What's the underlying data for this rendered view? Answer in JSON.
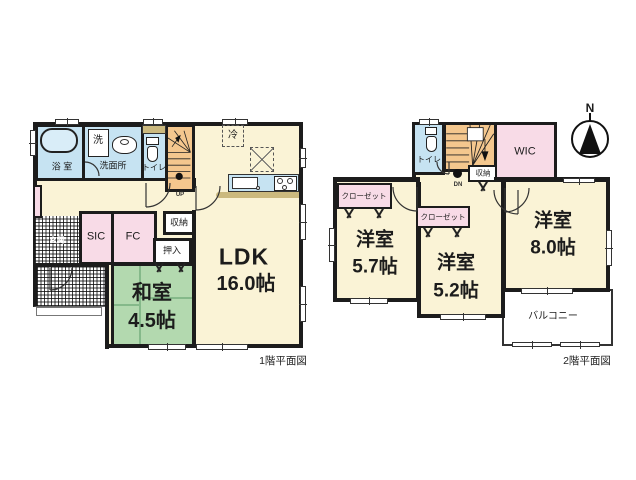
{
  "title": "間取り図",
  "colors": {
    "wall": "#1c1c1c",
    "room_cream": "#FAF3D6",
    "water_blue": "#C6E3F2",
    "stair_orange": "#F4C78E",
    "closet_pink": "#F8DBE7",
    "tatami_green": "#B3D9AF",
    "counter_tan": "#CBB97E"
  },
  "floor1": {
    "caption": "1階平面図",
    "bath": "浴 室",
    "laundry": "洗",
    "washroom": "洗面所",
    "toilet": "トイレ",
    "up": "UP",
    "fridge": "冷",
    "ldk_name": "LDK",
    "ldk_size": "16.0帖",
    "storage": "収納",
    "oshiire": "押入",
    "sic": "SIC",
    "fc": "FC",
    "genkan": "玄関",
    "washitsu_name": "和室",
    "washitsu_size": "4.5帖"
  },
  "floor2": {
    "caption": "2階平面図",
    "toilet": "トイレ",
    "down": "DN",
    "storage": "収納",
    "wic": "WIC",
    "closet_a": "クローゼット",
    "closet_b": "クローゼット",
    "room1_name": "洋室",
    "room1_size": "5.7帖",
    "room2_name": "洋室",
    "room2_size": "5.2帖",
    "room3_name": "洋室",
    "room3_size": "8.0帖",
    "balcony": "バルコニー"
  },
  "compass": {
    "north": "N"
  }
}
